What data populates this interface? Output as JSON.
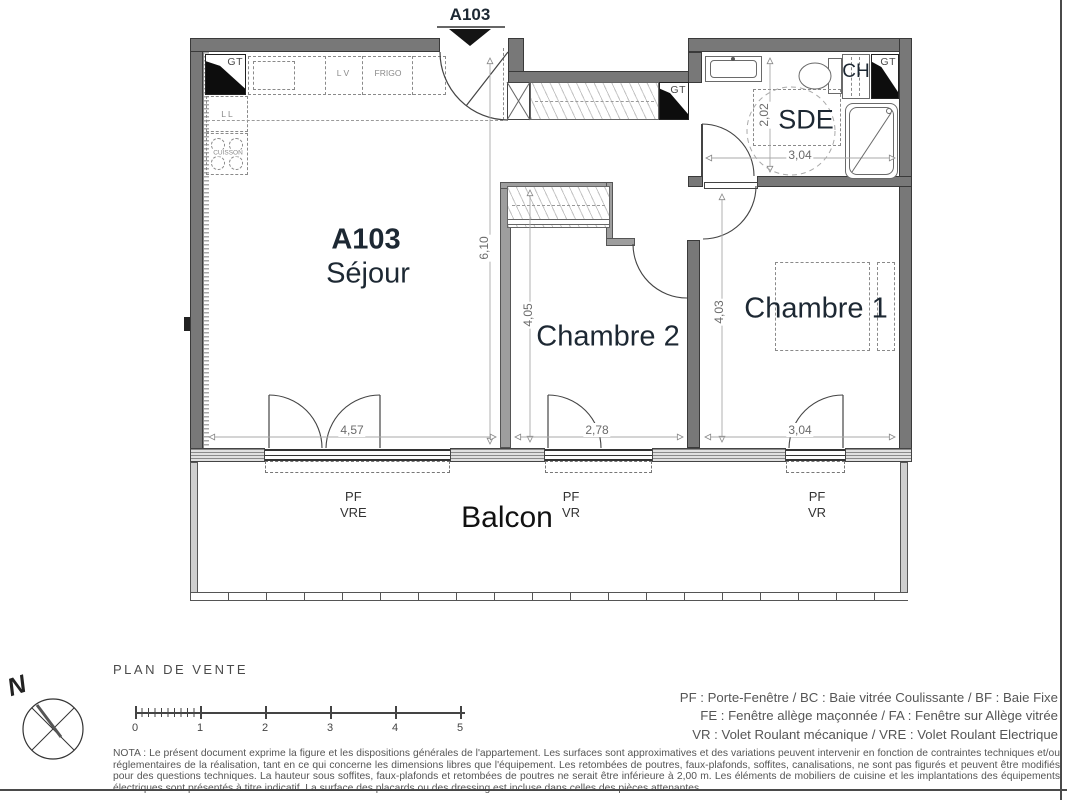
{
  "plan": {
    "entry_marker": "A103",
    "rooms": {
      "sejour_code": "A103",
      "sejour": "Séjour",
      "chambre2": "Chambre 2",
      "chambre1": "Chambre 1",
      "sde": "SDE",
      "balcon": "Balcon"
    },
    "equipment": {
      "gt": "GT",
      "ch": "CH",
      "lv": "L V",
      "frigo": "FRIGO",
      "ll": "L L",
      "cuisson": "CUISSON"
    },
    "dimensions": {
      "sejour_height": "6,10",
      "sejour_width": "4,57",
      "chambre2_height": "4,05",
      "chambre2_width": "2,78",
      "chambre1_height": "4,03",
      "chambre1_width": "3,04",
      "sde_height": "2,02",
      "sde_width": "3,04"
    },
    "windows": {
      "sejour_type": "PF",
      "sejour_shutter": "VRE",
      "chambre2_type": "PF",
      "chambre2_shutter": "VR",
      "chambre1_type": "PF",
      "chambre1_shutter": "VR"
    }
  },
  "footer": {
    "title": "PLAN DE VENTE",
    "compass_north": "N",
    "scale_ticks": [
      "0",
      "1",
      "2",
      "3",
      "4",
      "5"
    ],
    "abbreviations": [
      "PF : Porte-Fenêtre / BC : Baie vitrée Coulissante / BF : Baie Fixe",
      "FE : Fenêtre allège maçonnée / FA : Fenêtre sur Allège vitrée",
      "VR : Volet Roulant mécanique / VRE : Volet Roulant Electrique"
    ],
    "nota": "NOTA : Le présent document exprime la figure et les dispositions générales de l'appartement. Les surfaces sont approximatives et des variations peuvent intervenir en fonction de contraintes techniques et/ou réglementaires de la réalisation, tant en ce qui concerne les dimensions libres que l'équipement. Les retombées de poutres, faux-plafonds, soffites, canalisations, ne sont pas figurés et peuvent être modifiés pour des questions techniques. La hauteur sous soffites, faux-plafonds et retombées de poutres ne serait être inférieure à 2,00 m. Les éléments de mobiliers de cuisine et les implantations des équipements électriques sont présentés à titre indicatif. La surface des placards ou des dressing est incluse dans celles des pièces attenantes."
  }
}
